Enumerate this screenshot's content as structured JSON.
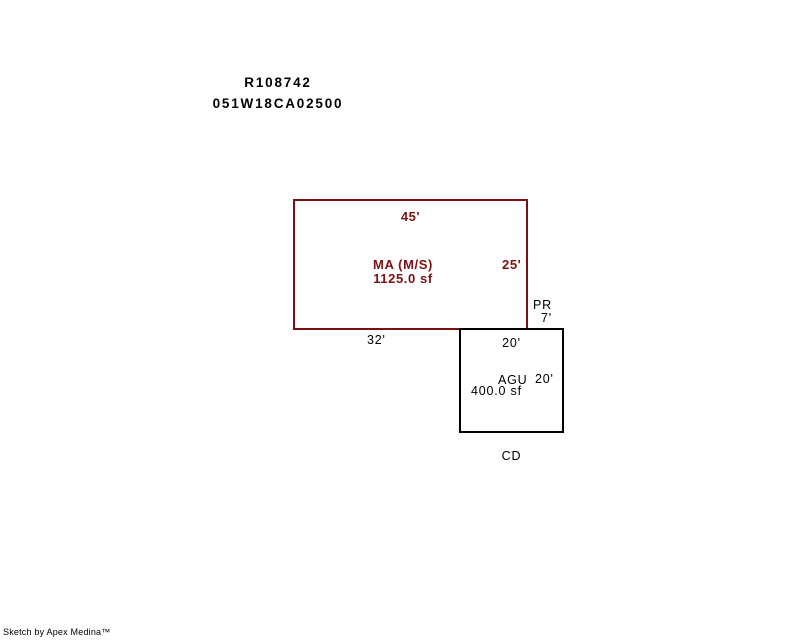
{
  "header": {
    "record_id": "R108742",
    "parcel_id": "051W18CA02500"
  },
  "sketch": {
    "main_area": {
      "code": "MA (M/S)",
      "area": "1125.0 sf",
      "dim_top": "45'",
      "dim_right": "25'",
      "dim_bottom": "32'"
    },
    "pr": {
      "code": "PR",
      "dim": "7'"
    },
    "agu": {
      "code": "AGU",
      "area": "400.0 sf",
      "dim_top": "20'",
      "dim_right": "20'"
    },
    "cd": {
      "code": "CD"
    },
    "colors": {
      "main_outline": "#7b1113",
      "secondary_outline": "#000000"
    }
  },
  "footer": {
    "credit": "Sketch by Apex Medina™"
  }
}
